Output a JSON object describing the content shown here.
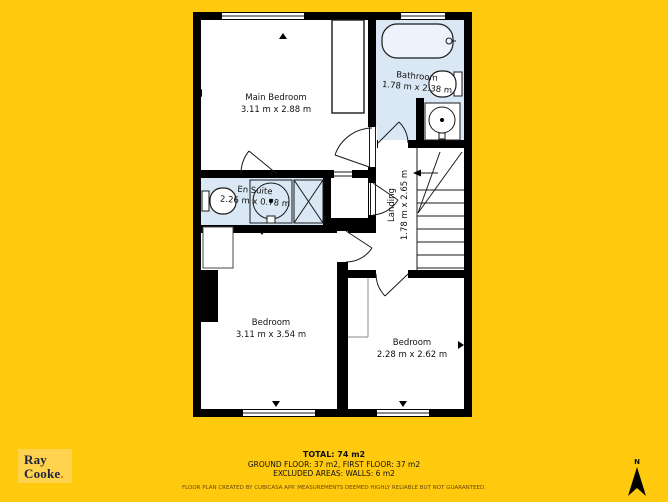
{
  "plan": {
    "rooms": {
      "main_bedroom": {
        "name": "Main Bedroom",
        "dims": "3.11 m x 2.88 m"
      },
      "bathroom": {
        "name": "Bathroom",
        "dims": "1.78 m x 2.38 m"
      },
      "en_suite": {
        "name": "En Suite",
        "dims": "2.26 m x 0.78 m"
      },
      "landing": {
        "name": "Landing",
        "dims": "1.78 m x 2.65 m"
      },
      "bedroom_left": {
        "name": "Bedroom",
        "dims": "3.11 m x 3.54 m"
      },
      "bedroom_right": {
        "name": "Bedroom",
        "dims": "2.28 m x 2.62 m"
      }
    },
    "fixtures": [
      "bathtub",
      "toilet",
      "sink",
      "shower",
      "shower-enclosure",
      "stairs",
      "wardrobe",
      "closet",
      "chimney-breast"
    ]
  },
  "footer": {
    "total": "TOTAL: 74 m2",
    "floors": "GROUND FLOOR: 37 m2, FIRST FLOOR: 37 m2",
    "excluded": "EXCLUDED AREAS: WALLS: 6 m2",
    "disclaimer": "FLOOR PLAN CREATED BY CUBICASA APP. MEASUREMENTS DEEMED HIGHLY RELIABLE BUT NOT GUARANTEED."
  },
  "logo": {
    "line1": "Ray",
    "line2": "Cooke",
    "period": "."
  },
  "compass": {
    "north_label": "N"
  },
  "colors": {
    "background": "#FFC90E",
    "wall": "#000000",
    "room_fill": "#FFFFFF",
    "wet_room_fill": "#DAE8F5",
    "logo_bg": "#FFD34D",
    "logo_text": "#23233F",
    "logo_period": "#EE6C1E"
  }
}
